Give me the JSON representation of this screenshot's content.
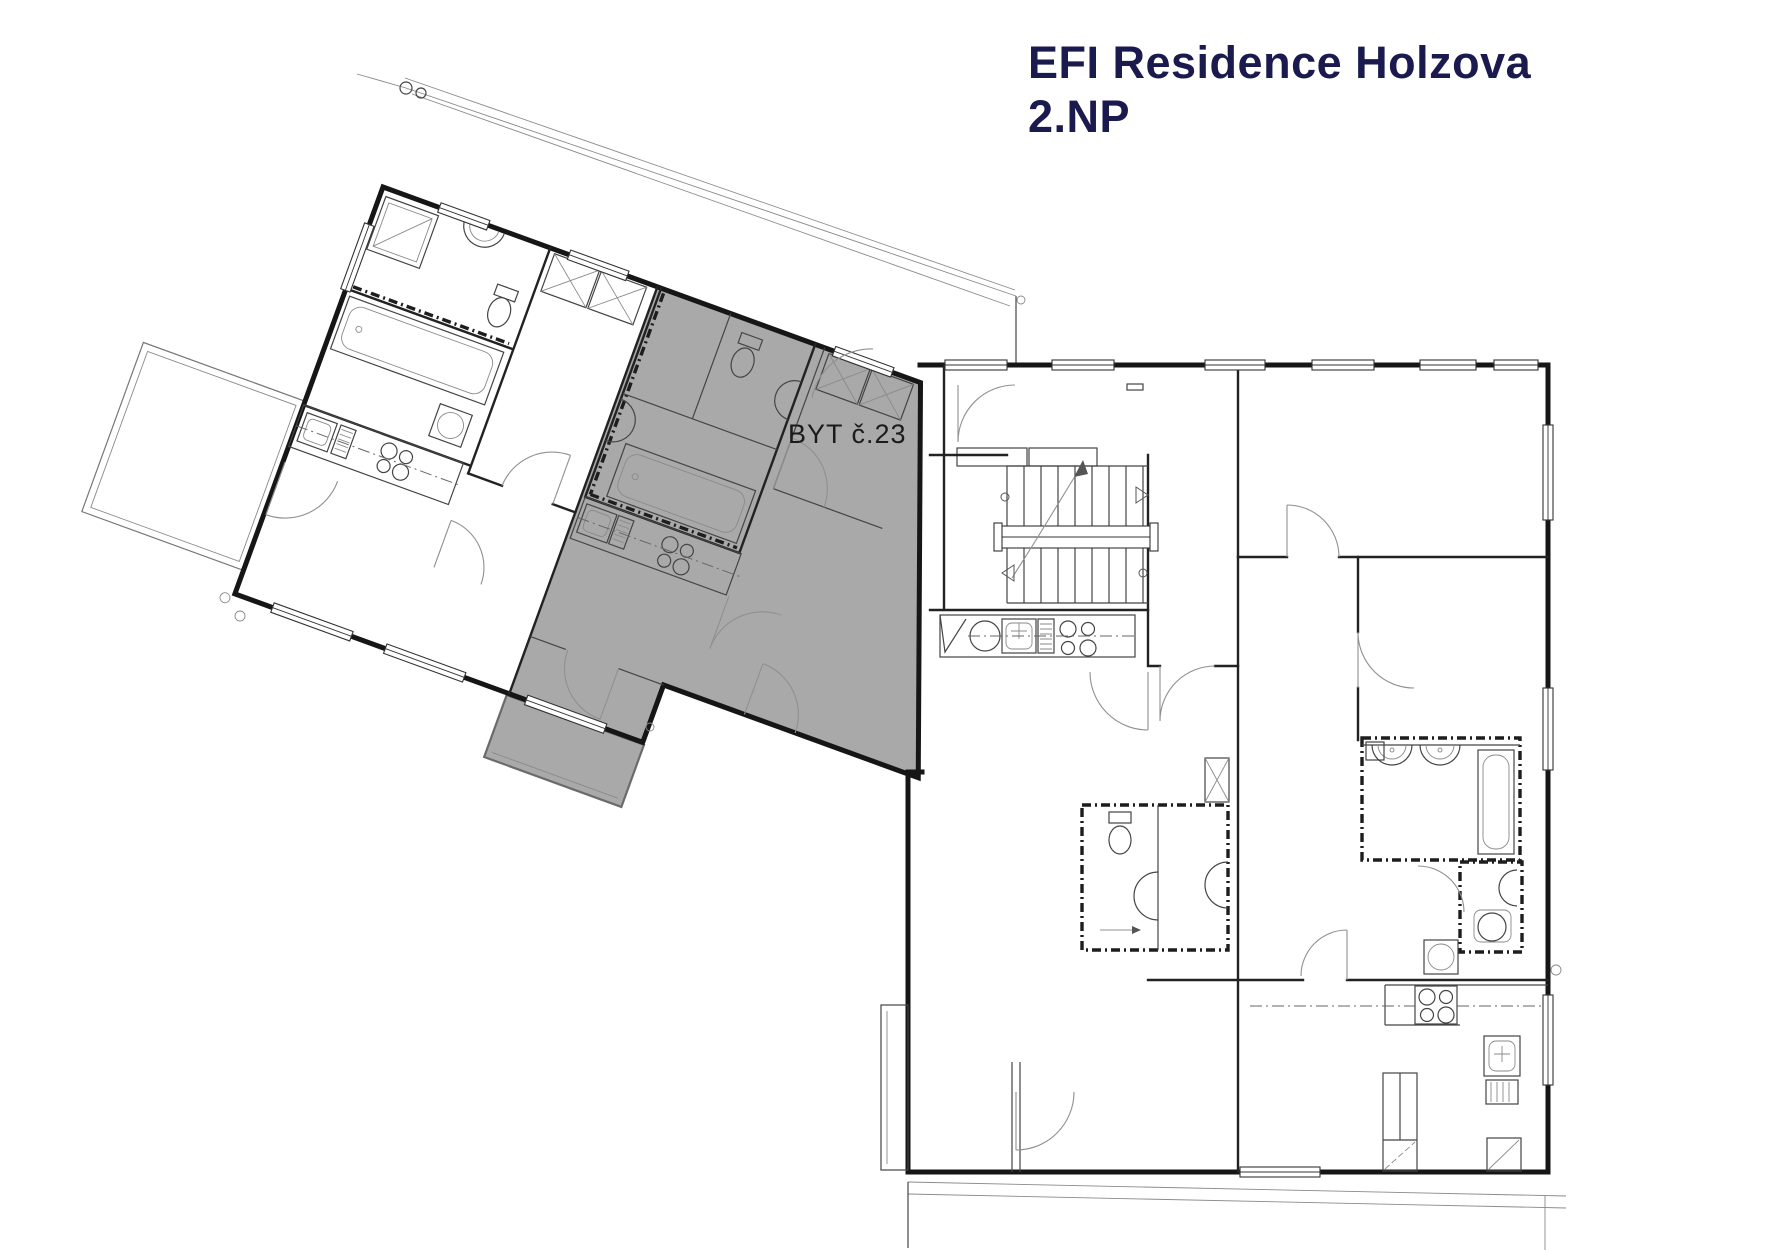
{
  "title": {
    "line1": "EFI Residence Holzova",
    "line2": "2.NP"
  },
  "plan": {
    "highlighted_unit_label": "BYT č.23"
  },
  "colors": {
    "highlight": "#a9a9a9",
    "title": "#1a1a4e",
    "wall": "#161616",
    "line": "#555555"
  }
}
